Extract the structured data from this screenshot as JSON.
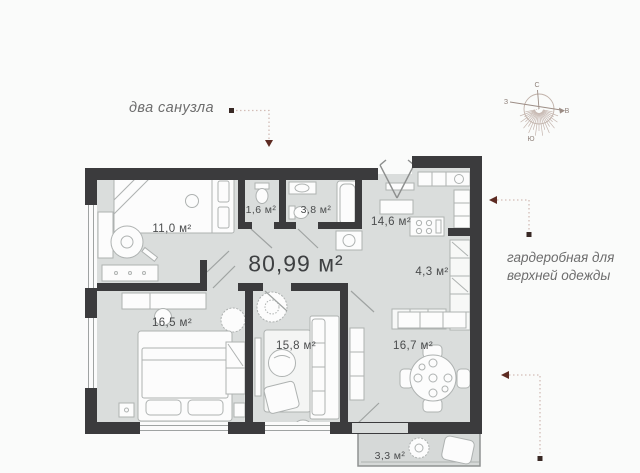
{
  "total_area": "80,99 м²",
  "rooms": [
    {
      "id": "bedroom-1",
      "area": "11,0 м²"
    },
    {
      "id": "wc-small",
      "area": "1,6 м²"
    },
    {
      "id": "bathroom",
      "area": "3,8 м²"
    },
    {
      "id": "kitchen",
      "area": "14,6 м²"
    },
    {
      "id": "wardrobe",
      "area": "4,3 м²"
    },
    {
      "id": "bedroom-2",
      "area": "16,5 м²"
    },
    {
      "id": "room-3",
      "area": "15,8 м²"
    },
    {
      "id": "living",
      "area": "16,7 м²"
    },
    {
      "id": "balcony",
      "area": "3,3 м²"
    }
  ],
  "annotations": {
    "two_bathrooms": "два санузла",
    "wardrobe_note": "гардеробная для верхней одежды"
  },
  "compass": {
    "north": "С",
    "south": "Ю",
    "west": "З",
    "east": "В"
  },
  "colors": {
    "wall": "#3b3b3d",
    "floor": "#dadddc",
    "furniture_stroke": "#aeb2b1",
    "accent_leader": "#5d2b22",
    "leader_dots": "#d3bdb6",
    "annotation_text": "#6d6d6d",
    "label_text": "#4a4c4d",
    "compass_stroke": "#c0b1a9"
  }
}
